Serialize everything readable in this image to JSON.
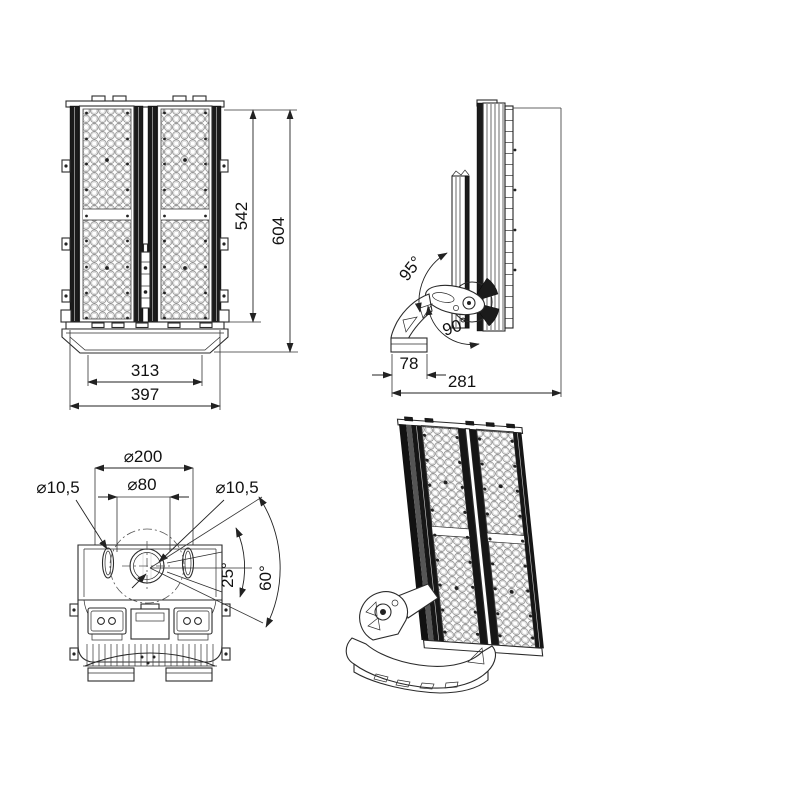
{
  "drawing": {
    "background": "#ffffff",
    "line_color": "#2b2b2b",
    "views": {
      "front": {
        "label": "front-view",
        "dims": {
          "led_height": "542",
          "total_height": "604",
          "bracket_width": "313",
          "total_width": "397"
        }
      },
      "side": {
        "label": "side-view",
        "dims": {
          "tilt_back_angle": "95°",
          "tilt_forward_angle": "90°",
          "base_depth": "78",
          "total_depth": "281"
        }
      },
      "top": {
        "label": "top-view",
        "dims": {
          "bolt_circle_dia": "⌀200",
          "left_hole_dia": "⌀10,5",
          "center_hole_dia": "⌀80",
          "right_hole_dia": "⌀10,5",
          "swivel_angle_inner": "25°",
          "swivel_angle_outer": "60°"
        }
      },
      "iso": {
        "label": "isometric-view"
      }
    }
  }
}
